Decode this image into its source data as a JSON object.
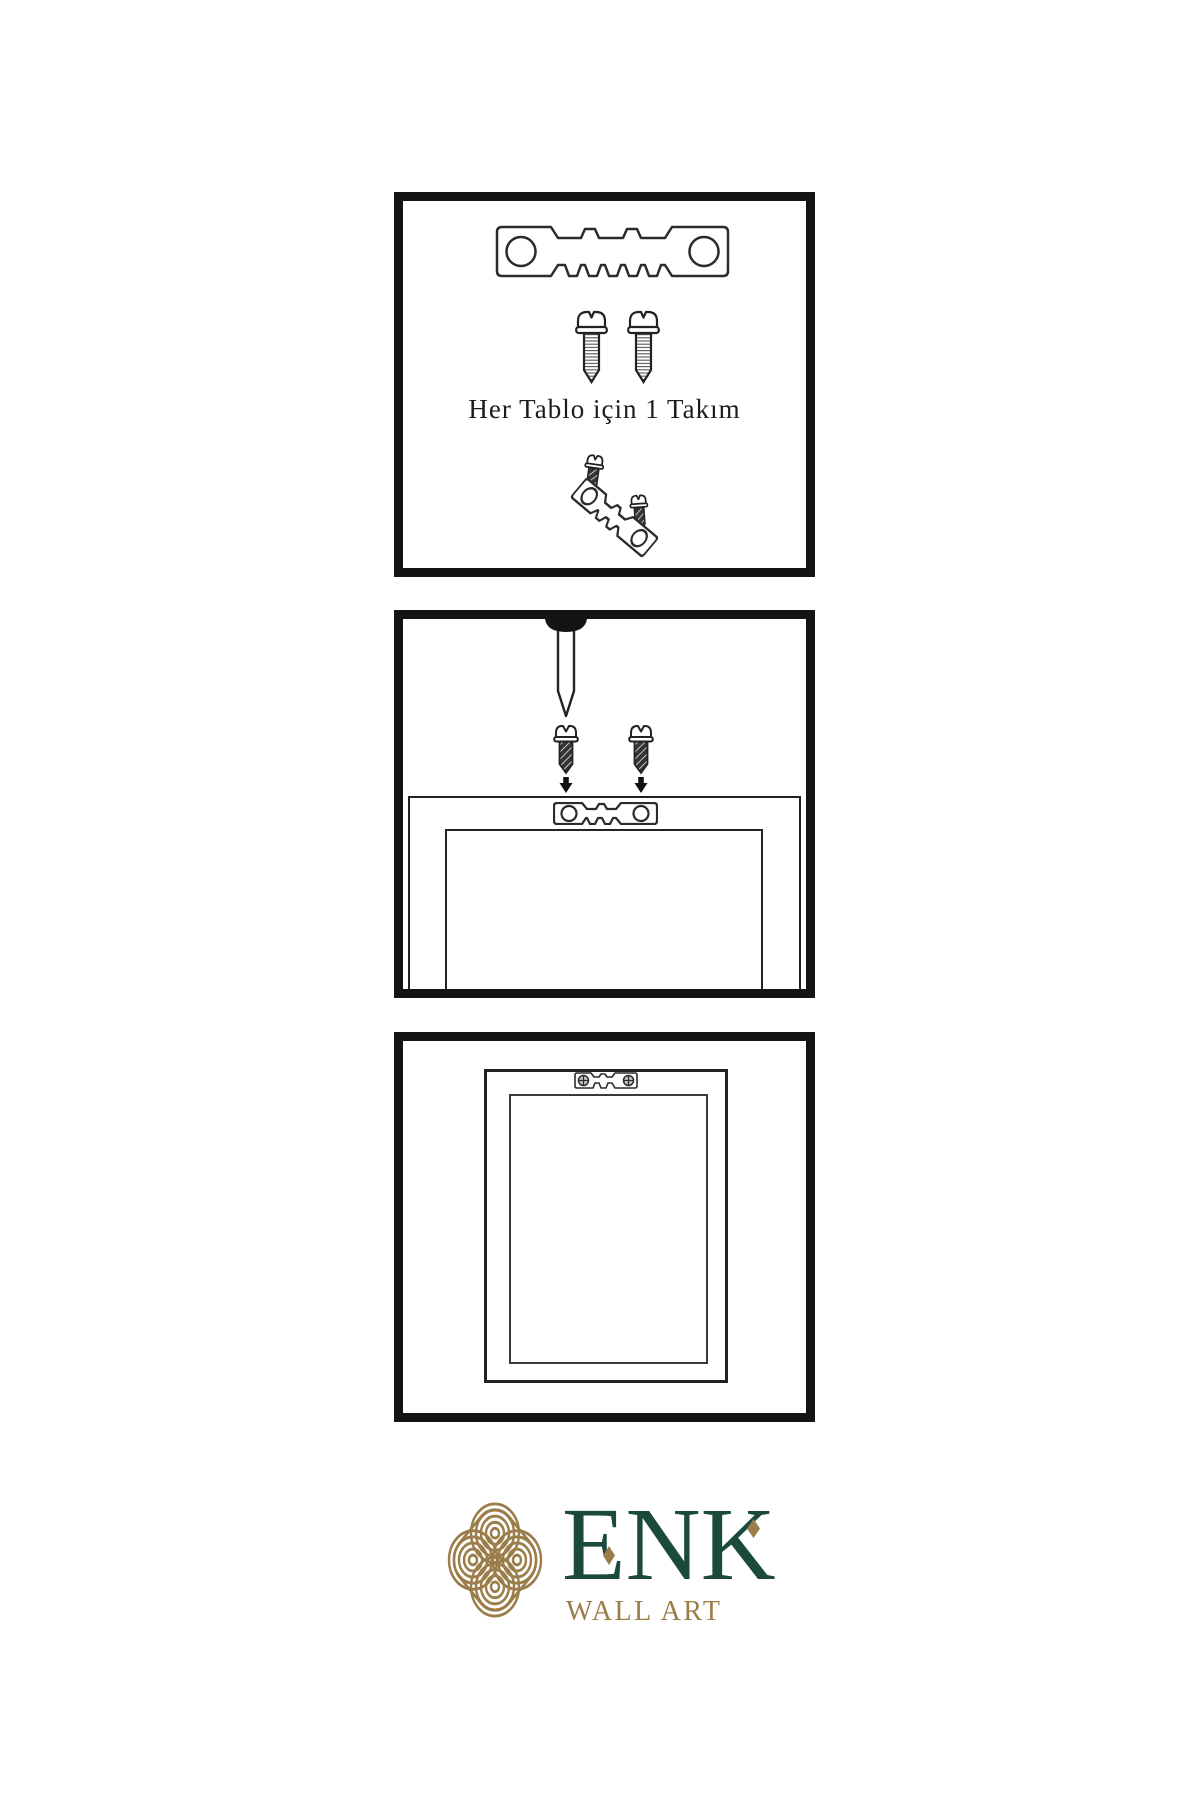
{
  "colors": {
    "background": "#ffffff",
    "panel_border": "#141414",
    "line_art": "#222222",
    "logo_green": "#1b4a3c",
    "logo_gold": "#9b7d4a"
  },
  "step1": {
    "caption": "Her Tablo için 1 Takım"
  },
  "logo": {
    "name": "ENK",
    "subtitle": "WALL ART"
  }
}
